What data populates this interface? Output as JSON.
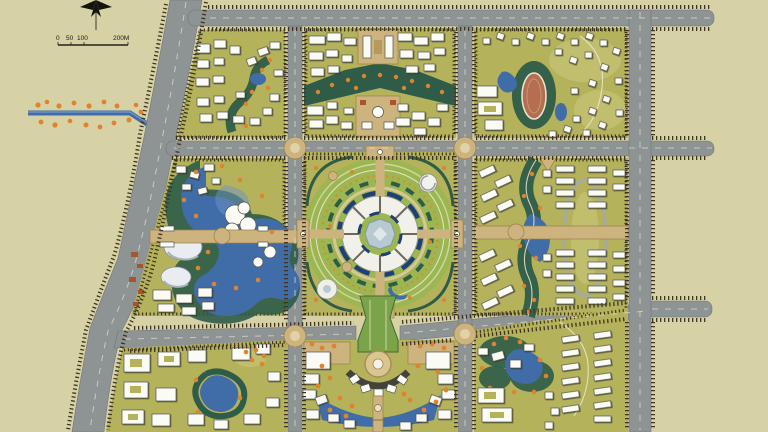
{
  "title": "Residential district master plan rendering",
  "scale_bar": {
    "labels": [
      "0",
      "50",
      "100",
      "200M"
    ]
  },
  "icons": {
    "compass": "north-arrow-icon"
  },
  "colors": {
    "bg": "#d6d2a5",
    "road": "#8e9394",
    "roadDark": "#70767a",
    "roadLine": "#dddcd3",
    "hatch": "#3f3422",
    "block": "#b4b25b",
    "blockLight": "#c6c173",
    "lawn": "#9cb751",
    "treeDark": "#2e5c49",
    "treeMid": "#4e7b4e",
    "water": "#406ca8",
    "waterLight": "#6e93c5",
    "bld": "#fbfbf6",
    "bldEdge": "#55534a",
    "orange": "#e0832e",
    "tan": "#cdb47e",
    "tanDark": "#9a7f4a",
    "navy": "#1f3f78",
    "track": "#b56f50",
    "red": "#a8552e",
    "plaza": "#b9c9d2",
    "text": "#1a1a14"
  }
}
